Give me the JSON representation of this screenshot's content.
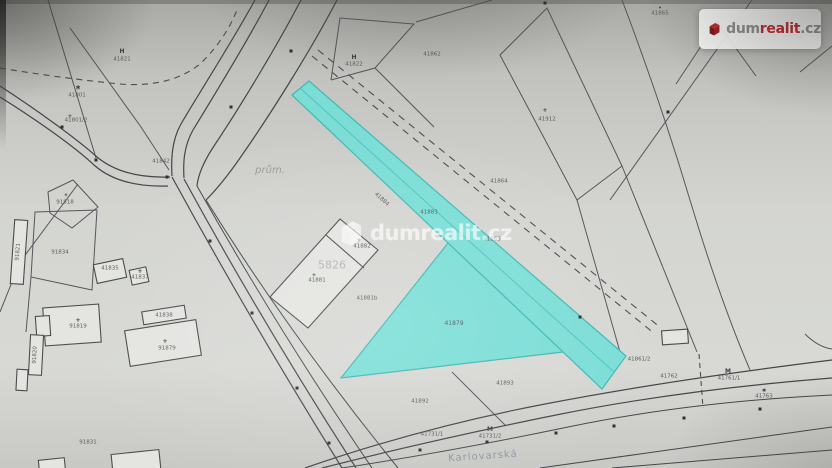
{
  "logo": {
    "prefix": "dum",
    "mid": "realit",
    "suffix": ".cz",
    "icon": "house-logo-icon"
  },
  "watermark": {
    "prefix": "dum",
    "mid": "realit",
    "suffix": ".cz",
    "icon": "house-watermark-icon"
  },
  "map": {
    "type": "cadastral-map-photo",
    "highlight_color": "#74ded7",
    "highlight_stroke": "#3fb9b2",
    "line_color": "#54575a",
    "paper_color": "#d3d4d0",
    "highlighted_parcel_labels": [
      "41883",
      "41879"
    ],
    "street_name": "Karlovarská",
    "labels": [
      {
        "text": "41821",
        "x": 122,
        "y": 60
      },
      {
        "text": "41801",
        "x": 77,
        "y": 96
      },
      {
        "text": "41801/2",
        "x": 76,
        "y": 121
      },
      {
        "text": "41822",
        "x": 354,
        "y": 65
      },
      {
        "text": "41862",
        "x": 432,
        "y": 55
      },
      {
        "text": "41865",
        "x": 660,
        "y": 14
      },
      {
        "text": "41912",
        "x": 547,
        "y": 120
      },
      {
        "text": "prům.",
        "x": 270,
        "y": 171,
        "size": 10,
        "color": "#9b9c96",
        "italic": true
      },
      {
        "text": "41842",
        "x": 161,
        "y": 162
      },
      {
        "text": "5826",
        "x": 332,
        "y": 265,
        "size": 11,
        "color": "#b3b4b0"
      },
      {
        "text": "41882",
        "x": 362,
        "y": 247
      },
      {
        "text": "41881",
        "x": 317,
        "y": 281
      },
      {
        "text": "41881b",
        "x": 367,
        "y": 299
      },
      {
        "text": "41884",
        "x": 381,
        "y": 200,
        "rot": 42
      },
      {
        "text": "41883",
        "x": 429,
        "y": 213
      },
      {
        "text": "41863",
        "x": 492,
        "y": 240
      },
      {
        "text": "41864",
        "x": 499,
        "y": 182
      },
      {
        "text": "41879",
        "x": 454,
        "y": 324,
        "size": 6
      },
      {
        "text": "91818",
        "x": 65,
        "y": 203
      },
      {
        "text": "91834",
        "x": 60,
        "y": 253
      },
      {
        "text": "41835",
        "x": 110,
        "y": 269
      },
      {
        "text": "41837",
        "x": 140,
        "y": 278
      },
      {
        "text": "91819",
        "x": 78,
        "y": 327
      },
      {
        "text": "91820",
        "x": 36,
        "y": 355,
        "rot": -87
      },
      {
        "text": "91821",
        "x": 19,
        "y": 252,
        "rot": -85
      },
      {
        "text": "41838",
        "x": 164,
        "y": 316
      },
      {
        "text": "91879",
        "x": 167,
        "y": 349
      },
      {
        "text": "91831",
        "x": 88,
        "y": 443
      },
      {
        "text": "41892",
        "x": 420,
        "y": 402
      },
      {
        "text": "41893",
        "x": 505,
        "y": 384
      },
      {
        "text": "41731/1",
        "x": 432,
        "y": 435
      },
      {
        "text": "41731/2",
        "x": 490,
        "y": 437
      },
      {
        "text": "41861/2",
        "x": 639,
        "y": 360
      },
      {
        "text": "41762",
        "x": 669,
        "y": 377
      },
      {
        "text": "41761/1",
        "x": 729,
        "y": 379
      },
      {
        "text": "41763",
        "x": 764,
        "y": 397
      },
      {
        "text": "Karlovarská",
        "x": 483,
        "y": 457,
        "size": 10,
        "color": "#8e97a1",
        "rot": -4,
        "spacing": 1
      }
    ],
    "symbols": [
      {
        "glyph": "H",
        "x": 122,
        "y": 52,
        "size": 6
      },
      {
        "glyph": "∗",
        "x": 78,
        "y": 88,
        "size": 7
      },
      {
        "glyph": "H",
        "x": 354,
        "y": 58,
        "size": 6
      },
      {
        "glyph": "+",
        "x": 545,
        "y": 111,
        "size": 6
      },
      {
        "glyph": "•",
        "x": 660,
        "y": 9,
        "size": 5
      },
      {
        "glyph": "+",
        "x": 66,
        "y": 196,
        "size": 5
      },
      {
        "glyph": "+",
        "x": 140,
        "y": 272,
        "size": 6
      },
      {
        "glyph": "+",
        "x": 359,
        "y": 241,
        "size": 5
      },
      {
        "glyph": "+",
        "x": 314,
        "y": 276,
        "size": 5
      },
      {
        "glyph": "+",
        "x": 78,
        "y": 321,
        "size": 6
      },
      {
        "glyph": "+",
        "x": 165,
        "y": 342,
        "size": 6
      },
      {
        "glyph": "M",
        "x": 490,
        "y": 430,
        "size": 6
      },
      {
        "glyph": "M",
        "x": 728,
        "y": 372,
        "size": 6
      },
      {
        "glyph": "∗",
        "x": 764,
        "y": 391,
        "size": 6
      },
      {
        "glyph": "+",
        "x": 70,
        "y": 117,
        "size": 5
      }
    ]
  }
}
